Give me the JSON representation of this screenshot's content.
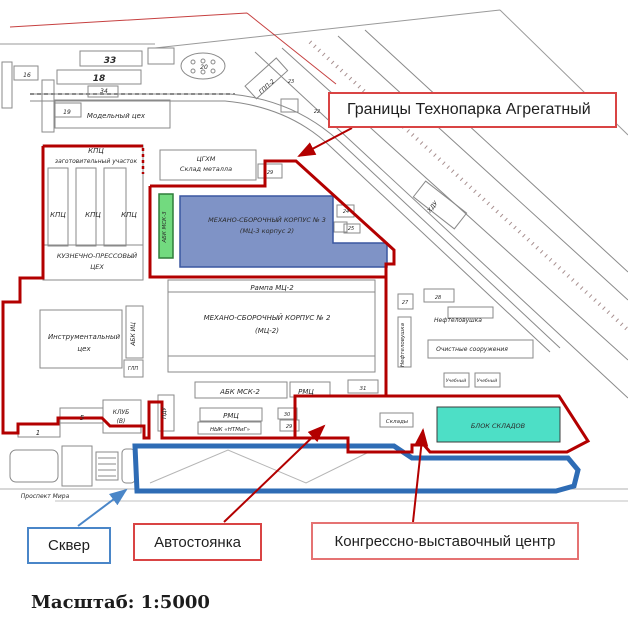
{
  "callouts": {
    "boundary": "Границы Технопарка Агрегатный",
    "skver": "Сквер",
    "parking": "Автостоянка",
    "congress": "Конгрессно-выставочный центр"
  },
  "scale_label": "Масштаб: 1:5000",
  "colors": {
    "boundary_red": "#b30000",
    "callout_red": "#d94444",
    "callout_red_light": "#e57373",
    "callout_blue": "#4a86c8",
    "skver_blue": "#2e6cb5",
    "building_blue_fill": "#7f93c6",
    "building_blue_stroke": "#3a57a0",
    "building_green_fill": "#72da7f",
    "building_green_stroke": "#2f7d3a",
    "building_teal_fill": "#4ddfc6",
    "building_teal_stroke": "#3c3c3c",
    "map_line": "#8a8a8a",
    "map_text": "#2b2b2b"
  },
  "map": {
    "labels": [
      {
        "t": "33",
        "x": 110,
        "y": 63,
        "s": 9,
        "b": 1
      },
      {
        "t": "18",
        "x": 99,
        "y": 81,
        "s": 9,
        "b": 1
      },
      {
        "t": "16",
        "x": 27,
        "y": 77,
        "s": 6
      },
      {
        "t": "34",
        "x": 104,
        "y": 93,
        "s": 6
      },
      {
        "t": "19",
        "x": 67,
        "y": 114,
        "s": 6
      },
      {
        "t": "Модельный цех",
        "x": 116,
        "y": 118,
        "s": 7
      },
      {
        "t": "20",
        "x": 204,
        "y": 69,
        "s": 6
      },
      {
        "t": "ГПП-2",
        "x": 268,
        "y": 88,
        "s": 6,
        "r": -42
      },
      {
        "t": "23",
        "x": 291,
        "y": 83,
        "s": 5
      },
      {
        "t": "22",
        "x": 317,
        "y": 113,
        "s": 5
      },
      {
        "t": "КПЦ",
        "x": 96,
        "y": 153,
        "s": 7
      },
      {
        "t": "заготовительный участок",
        "x": 96,
        "y": 163,
        "s": 6
      },
      {
        "t": "ЦГХМ",
        "x": 206,
        "y": 161,
        "s": 6.5
      },
      {
        "t": "Склад металла",
        "x": 206,
        "y": 171,
        "s": 6.5
      },
      {
        "t": "29",
        "x": 270,
        "y": 174,
        "s": 5
      },
      {
        "t": "КПЦ",
        "x": 58,
        "y": 217,
        "s": 7
      },
      {
        "t": "КПЦ",
        "x": 93,
        "y": 217,
        "s": 7
      },
      {
        "t": "КПЦ",
        "x": 129,
        "y": 217,
        "s": 7
      },
      {
        "t": "КУЗНЕЧНО-ПРЕССОВЫЙ",
        "x": 97,
        "y": 258,
        "s": 6.5
      },
      {
        "t": "ЦЕХ",
        "x": 97,
        "y": 269,
        "s": 6.5
      },
      {
        "t": "АБК МСК-3",
        "x": 166,
        "y": 227,
        "s": 5.5,
        "r": -90
      },
      {
        "t": "МЕХАНО-СБОРОЧНЫЙ КОРПУС № 3",
        "x": 267,
        "y": 222,
        "s": 6.5,
        "c": "#101c5a"
      },
      {
        "t": "(МЦ-3 корпус 2)",
        "x": 267,
        "y": 233,
        "s": 6.5,
        "c": "#101c5a"
      },
      {
        "t": "24",
        "x": 346,
        "y": 213,
        "s": 5
      },
      {
        "t": "25",
        "x": 351,
        "y": 230,
        "s": 5
      },
      {
        "t": "Рампа МЦ-2",
        "x": 272,
        "y": 290,
        "s": 7
      },
      {
        "t": "МЕХАНО-СБОРОЧНЫЙ КОРПУС № 2",
        "x": 267,
        "y": 320,
        "s": 7
      },
      {
        "t": "(МЦ-2)",
        "x": 267,
        "y": 333,
        "s": 7
      },
      {
        "t": "Инструментальный",
        "x": 84,
        "y": 339,
        "s": 7
      },
      {
        "t": "цех",
        "x": 84,
        "y": 351,
        "s": 7
      },
      {
        "t": "АБК ИЦ",
        "x": 135,
        "y": 334,
        "s": 6,
        "r": -90
      },
      {
        "t": "ГЛП",
        "x": 133,
        "y": 370,
        "s": 5
      },
      {
        "t": "АБК МСК-2",
        "x": 240,
        "y": 394,
        "s": 7
      },
      {
        "t": "РМЦ",
        "x": 306,
        "y": 394,
        "s": 7
      },
      {
        "t": "31",
        "x": 363,
        "y": 390,
        "s": 5.5
      },
      {
        "t": "РМЦ",
        "x": 231,
        "y": 418,
        "s": 7
      },
      {
        "t": "НЫК «НТМиГ»",
        "x": 230,
        "y": 431,
        "s": 5.5
      },
      {
        "t": "30",
        "x": 287,
        "y": 416,
        "s": 5
      },
      {
        "t": "29",
        "x": 289,
        "y": 428,
        "s": 5
      },
      {
        "t": "5",
        "x": 82,
        "y": 420,
        "s": 7
      },
      {
        "t": "1",
        "x": 38,
        "y": 435,
        "s": 7
      },
      {
        "t": "КЛУБ",
        "x": 121,
        "y": 414,
        "s": 6
      },
      {
        "t": "(В)",
        "x": 121,
        "y": 423,
        "s": 6
      },
      {
        "t": "ПДУ",
        "x": 166,
        "y": 413,
        "s": 5.5,
        "r": -90
      },
      {
        "t": "Склады",
        "x": 397,
        "y": 423,
        "s": 5.5
      },
      {
        "t": "БЛОК СКЛАДОВ",
        "x": 498,
        "y": 428,
        "s": 6.5,
        "c": "#0a6a5a"
      },
      {
        "t": "27",
        "x": 405,
        "y": 304,
        "s": 5
      },
      {
        "t": "28",
        "x": 438,
        "y": 299,
        "s": 5
      },
      {
        "t": "Нефтеловушка",
        "x": 458,
        "y": 322,
        "s": 6
      },
      {
        "t": "Нефтеловушка",
        "x": 404,
        "y": 345,
        "s": 5.5,
        "r": -90
      },
      {
        "t": "Очистные сооружения",
        "x": 472,
        "y": 351,
        "s": 6
      },
      {
        "t": "Учебный",
        "x": 456,
        "y": 382,
        "s": 4.5
      },
      {
        "t": "Учебный",
        "x": 487,
        "y": 382,
        "s": 4.5
      },
      {
        "t": "ХДУ",
        "x": 434,
        "y": 208,
        "s": 6,
        "r": -52
      },
      {
        "t": "Проспект Мира",
        "x": 45,
        "y": 498,
        "s": 6
      }
    ]
  }
}
